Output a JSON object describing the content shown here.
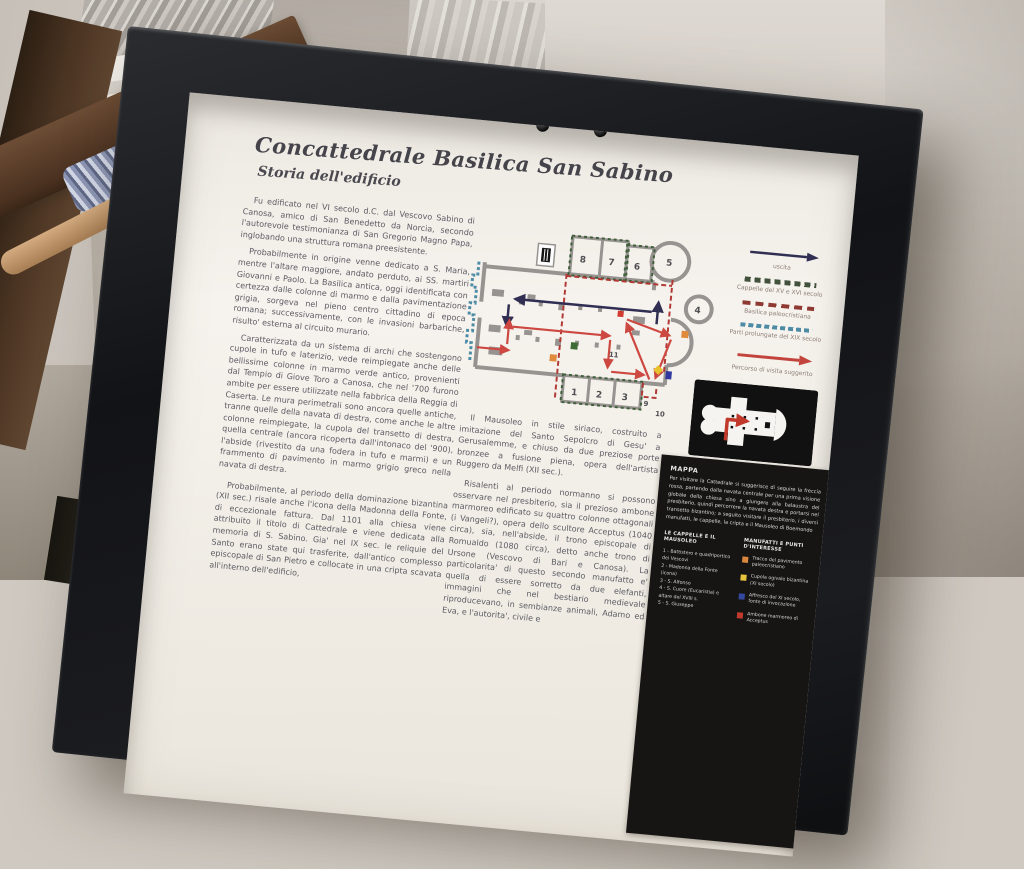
{
  "panel": {
    "title": "Concattedrale Basilica San Sabino",
    "subtitle": "Storia dell'edificio",
    "left_column": {
      "p1": "Fu edificato nel VI secolo d.C. dal Vescovo Sabino di Canosa, amico di San Benedetto da Norcia, secondo l'autorevole testimonianza di San Gregorio Magno Papa, inglobando una struttura romana preesistente.",
      "p2": "Probabilmente in origine venne dedicato a S. Maria, mentre l'altare maggiore, andato perduto, ai SS. martiri Giovanni e Paolo. La Basilica antica, oggi identificata con certezza dalle colonne di marmo e dalla pavimentazione grigia, sorgeva nel pieno centro cittadino di epoca romana; successivamente, con le invasioni barbariche, risulto' esterna al circuito murario.",
      "p3": "Caratterizzata da un sistema di archi che sostengono cupole in tufo e laterizio, vede reimpiegate anche delle bellissime colonne in marmo verde antico, provenienti dal Tempio di Giove Toro a Canosa, che nel '700 furono ambite per essere utilizzate nella fabbrica della Reggia di Caserta. Le mura perimetrali sono ancora quelle antiche, tranne quelle della navata di destra, come anche le altre colonne reimpiegate, la cupola del transetto di destra, quella centrale (ancora ricoperta dall'intonaco del '900), l'abside (rivestito da una fodera in tufo e marmi) e un frammento di pavimento in marmo grigio greco nella navata di destra.",
      "p4": "Probabilmente, al periodo della dominazione bizantina (XII sec.) risale anche l'icona della Madonna della Fonte, di eccezionale fattura. Dal 1101 alla chiesa viene attribuito il titolo di Cattedrale e viene dedicata alla memoria di S. Sabino. Gia' nel IX sec. le reliquie del Santo erano state qui trasferite, dall'antico complesso episcopale di San Pietro e collocate in una cripta scavata all'interno dell'edificio,"
    },
    "middle_column": {
      "p1": "Il Mausoleo in stile siriaco, costruito a imitazione del Santo Sepolcro di Gesu' a Gerusalemme, e chiuso da due preziose porte bronzee a fusione piena, opera dell'artista Ruggero da Melfi (XII sec.).",
      "p2": "Risalenti al periodo normanno si possono osservare nel presbiterio, sia il prezioso ambone marmoreo edificato su quattro colonne ottagonali (i Vangeli?), opera dello scultore Acceptus (1040 circa), sia, nell'abside, il trono episcopale di Romualdo (1080 circa), detto anche trono di Ursone (Vescovo di Bari e Canosa). La particolarita' di questo secondo manufatto e' quella di essere sorretto da due elefanti, immagini che nel bestiario medievale riproducevano, in sembianze animali, Adamo ed Eva, e l'autorita', civile e"
    },
    "plan": {
      "rooms": [
        "8",
        "7",
        "6",
        "5",
        "4",
        "1",
        "2",
        "3",
        "11",
        "9",
        "10"
      ]
    },
    "legend": {
      "items": [
        {
          "symbol": "navy-arrow",
          "color": "#302e52",
          "label": "uscita"
        },
        {
          "symbol": "green-dashed-squares",
          "color": "#42513c",
          "label": "Cappelle del XV e XVI secolo"
        },
        {
          "symbol": "red-dashed",
          "color": "#8e3a32",
          "label": "Basilica paleocristiana"
        },
        {
          "symbol": "teal-dotted",
          "color": "#4e8ca6",
          "label": "Parti prolungate del XIX secolo"
        },
        {
          "symbol": "red-arrow",
          "color": "#c2443c",
          "label": "Percorso di visita suggerito"
        }
      ]
    },
    "cripta_caption": "Cripta",
    "mappa": {
      "title": "MAPPA",
      "body": "Per visitare la Cattedrale si suggerisce di seguire la freccia rossa, partendo dalla navata centrale per una prima visione globale della chiesa sino a giungere alla balaustra del presbiterio, quindi percorrere la navata destra e portarsi nel transetto bizantino; a seguito visitare il presbiterio, i diversi manufatti, le cappelle, la cripta e il Mausoleo di Boemondo",
      "cappelle": {
        "heading": "LE CAPPELLE E IL MAUSOLEO",
        "items": [
          "1 - Battistero e quadriportico dei Vescovi",
          "2 - Madonna della Fonte (icona)",
          "3 - S. Alfonso",
          "4 - S. Cuore (Eucaristia) e altare del XVIII s.",
          "5 - S. Giuseppe"
        ]
      },
      "manufatti": {
        "heading": "MANUFATTI E PUNTI D'INTERESSE",
        "items": [
          {
            "color": "#d9863f",
            "label": "Tracce del pavimento paleocristiano"
          },
          {
            "color": "#e6c33c",
            "label": "Cupola ogivale bizantina (XI secolo)"
          },
          {
            "color": "#3548a0",
            "label": "Affresco del XI secolo, fonte di invocazione"
          },
          {
            "color": "#c03a2e",
            "label": "Ambone marmoreo di Acceptus"
          }
        ]
      }
    }
  }
}
